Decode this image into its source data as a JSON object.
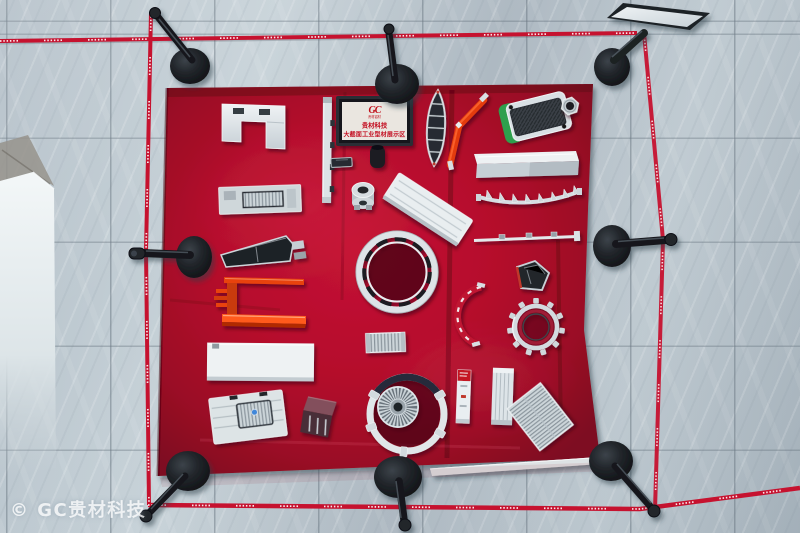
{
  "watermark": {
    "text": "© GC贵材科技"
  },
  "table_sign": {
    "logo": "GC",
    "logo_subtitle": "贵材铝材",
    "title": "贵材科技",
    "subtitle": "大截面工业型材展示区"
  },
  "colors": {
    "carpet_red": "#b50e2c",
    "carpet_shadow": "#84091f",
    "floor_tile": "#bac6ce",
    "grout_line": "#7f8c96",
    "barrier_tape": "#c6122f",
    "stanchion": "#17191d",
    "aluminum_silver": "#dde3e7",
    "accent_orange": "#e8430f",
    "accent_green": "#2fa04e",
    "sign_text_red": "#c31020"
  }
}
